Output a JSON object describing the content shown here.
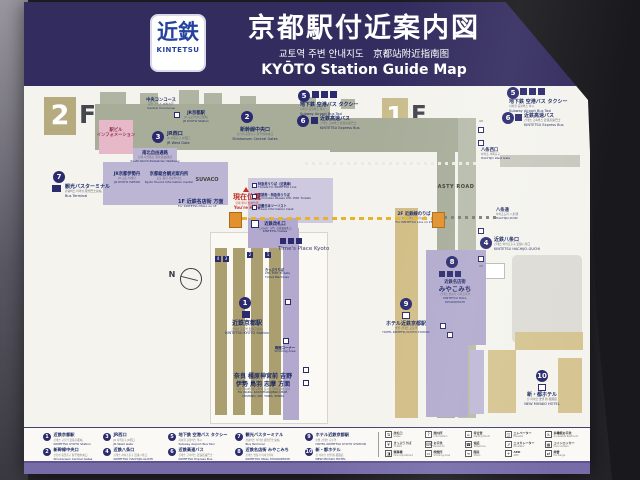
{
  "header": {
    "logo_jp": "近鉄",
    "logo_en": "KINTETSU",
    "title": "京都駅付近案内図",
    "subtitle": "교토역 주변 안내지도　京都站附近指南图",
    "title_en": "KYŌTO Station Guide Map"
  },
  "floors": {
    "two": "2",
    "one": "1",
    "f": "F"
  },
  "points": [
    {
      "n": "1",
      "jp": "近鉄京都駅",
      "sub": "긴테쓰 교토역 近铁京都站",
      "en": "KINTETSU KYOTO Station"
    },
    {
      "n": "2",
      "jp": "新幹線中央口",
      "sub": "신칸센 중앙출구 新干线中央口",
      "en": "Shinkansen Central Gates"
    },
    {
      "n": "3",
      "jp": "JR西口",
      "sub": "JR 서쪽출구 JR西口",
      "en": "JR West Gate"
    },
    {
      "n": "4",
      "jp": "近鉄八条口",
      "sub": "긴테쓰 하치조출구 近铁八条口",
      "en": "KINTETSU HACHIJO-GUCHI"
    },
    {
      "n": "5",
      "jp": "地下鉄 空港バス タクシー",
      "sub": "지하철 공항버스 택시",
      "en": "Subway  Airport Bus  Taxi"
    },
    {
      "n": "6",
      "jp": "近鉄高速バス",
      "sub": "긴테쓰 고속버스 近铁高速巴士",
      "en": "KINTETSU Express Bus"
    },
    {
      "n": "7",
      "jp": "観光バスターミナル",
      "sub": "관광버스 터미널 观光巴士总站",
      "en": "Bus Terminal"
    },
    {
      "n": "8",
      "jp": "近鉄名店街 みやこみち",
      "sub": "긴테쓰 명점가 미야코미치",
      "en": "KINTETSU MALL MIYAKOMICHI"
    },
    {
      "n": "9",
      "jp": "ホテル近鉄京都駅",
      "sub": "호텔 긴테쓰 교토역",
      "en": "HOTEL KINTETSU KYOTO STATION"
    },
    {
      "n": "10",
      "jp": "新・都ホテル",
      "sub": "신 미야코 호텔 新·都酒店",
      "en": "NEW MIYAKO HOTEL"
    }
  ],
  "map": {
    "cc": {
      "jp": "中央コンコース",
      "sub": "중앙 콘코스 中央大厅",
      "en": "Central Concourse"
    },
    "jr": {
      "jp": "JR京都駅",
      "sub": "JR 교토역 JR京都站",
      "en": "JR KYOTO Station"
    },
    "info": {
      "l1": "駅ビル",
      "l2": "インフォメーション"
    },
    "passage": {
      "jp": "南北自由通路",
      "sub": "남북 자유통로 南北自由通道",
      "en": "South-North Pedestrian Walkway"
    },
    "isetan": {
      "jp": "JR京都伊勢丹",
      "sub": "JR 교토 이세탄",
      "en": "JR KYOTO ISETAN"
    },
    "tourist": {
      "jp": "京都総合観光案内所",
      "sub": "교토 종합 관광안내소",
      "en": "Kyoto Tourist Information Center"
    },
    "suvaco": "SUVACO",
    "mall_dir": {
      "jp": "1F 近鉄名店街 方面",
      "en": "For KINTETSU MALL on 1F"
    },
    "youhere": {
      "jp": "現在位置",
      "sub": "현재 위치 当前位置",
      "en": "You're Here"
    },
    "t1": {
      "jp": "特急券うりば（近鉄線）",
      "en": "Tickets for KINTETSU Line"
    },
    "t2": {
      "jp": "定期券・特急券うりば",
      "en": "Commuter Passes LTD. EXP. Tickets"
    },
    "t3": {
      "jp": "近畿日本ツーリスト",
      "en": "Travel Information Desk"
    },
    "gates": {
      "jp": "近鉄改札口",
      "note": "このほか（2F）近鉄東改札口",
      "en": "KINTETSU Gates"
    },
    "times_place": "Time's Place Kyoto",
    "tracks": [
      "4",
      "3",
      "2",
      "1"
    ],
    "tvm": {
      "l1": "きっぷうりば",
      "l2": "LTD. EXP. Tickets",
      "l3": "Ticket Machines"
    },
    "smoking": {
      "jp": "喫煙コーナー",
      "en": "Smoking Area"
    },
    "dest": {
      "l1": "奈良 橿原神宮前 吉野",
      "l2": "伊勢 鳥羽 志摩 方面",
      "sub": "나라 가시하라진구마에 요시노 이세 도바 시마",
      "en1": "For NARA, KASHIHARAJINGU-MAE,",
      "en2": "YOSHINO, ISE, TOBA, SHIMA"
    },
    "asty": "ASTY ROAD",
    "hwest": {
      "jp": "八条西口",
      "sub": "하치조 서쪽출구",
      "en": "HACHIJO West Gate"
    },
    "hdori": {
      "jp": "八条通",
      "sub": "하치조도리 八条通",
      "en": "HACHIJO-DORI"
    },
    "line2f": {
      "jp": "2F 近鉄線のりば",
      "sub": "2F 긴테쓰센 타는 곳",
      "en": "For KINTETSU Line on 2F"
    },
    "mall8": {
      "l1": "近鉄名店街",
      "l2": "みやこみち",
      "en1": "KINTETSU MALL",
      "en2": "MIYAKOMICHI"
    },
    "compass": "N",
    "up": "UP"
  },
  "legend": {
    "pictos": [
      {
        "glyph": "⇅",
        "jp": "改札口",
        "en": "Gates"
      },
      {
        "glyph": "?",
        "jp": "案内所",
        "en": "Information"
      },
      {
        "glyph": "⌂",
        "jp": "待合室",
        "en": "Waiting Room"
      },
      {
        "glyph": "◫",
        "jp": "エレベーター",
        "en": "Elevator"
      },
      {
        "glyph": "♿",
        "jp": "多機能お手洗",
        "en": "Accessible Restroom"
      },
      {
        "glyph": "¥",
        "jp": "きっぷうりば",
        "en": "Tickets"
      },
      {
        "glyph": "WC",
        "jp": "お手洗",
        "en": "Restroom"
      },
      {
        "glyph": "☎",
        "jp": "電話",
        "en": "Telephone"
      },
      {
        "glyph": "⇗",
        "jp": "エスカレーター",
        "en": "Escalator"
      },
      {
        "glyph": "▦",
        "jp": "コインロッカー",
        "en": "Coin Lockers"
      },
      {
        "glyph": "◨",
        "jp": "精算機",
        "en": "Fare Adjustment"
      },
      {
        "glyph": "▭",
        "jp": "喫煙所",
        "en": "Smoking Area"
      },
      {
        "glyph": "≡",
        "jp": "階段",
        "en": "Stairs"
      },
      {
        "glyph": "+",
        "jp": "AED",
        "en": "AED"
      },
      {
        "glyph": "⇄",
        "jp": "両替",
        "en": "Exchange"
      }
    ]
  },
  "colors": {
    "header_navy": "#332c5f",
    "badge_navy": "#2b2a6e",
    "you_here_red": "#c03028",
    "route_yellow": "#e5b32c",
    "mall_purple": "#b2aacd",
    "platform_khaki": "#ab9f6f",
    "building_olive": "#a8ad9a",
    "footer_purple": "#776ca8"
  }
}
